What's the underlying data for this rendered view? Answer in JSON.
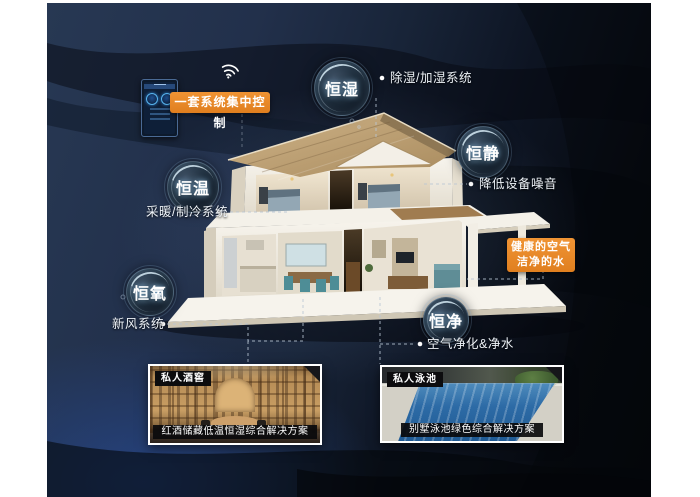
{
  "colors": {
    "canvas_navy": "#1c2b47",
    "accent_orange": "#e8872b",
    "bubble_text": "#ffffff",
    "caption_bg": "#0c0c0e"
  },
  "control_panel": {
    "label": "一套系统集中控制",
    "wifi_icon": "wifi-icon"
  },
  "bubbles": [
    {
      "id": "constant-humidity",
      "label": "恒湿"
    },
    {
      "id": "constant-quiet",
      "label": "恒静"
    },
    {
      "id": "constant-temperature",
      "label": "恒温"
    },
    {
      "id": "constant-oxygen",
      "label": "恒氧"
    },
    {
      "id": "constant-purity",
      "label": "恒净"
    }
  ],
  "annotations": [
    {
      "id": "dehumidify-humidify-system",
      "label": "除湿/加湿系统"
    },
    {
      "id": "reduce-equipment-noise",
      "label": "降低设备噪音"
    },
    {
      "id": "heating-cooling-system",
      "label": "采暖/制冷系统"
    },
    {
      "id": "fresh-air-system",
      "label": "新风系统"
    },
    {
      "id": "air-purification-water-purification",
      "label": "空气净化&净水"
    }
  ],
  "highlight_box": {
    "line1": "健康的空气",
    "line2": "洁净的水"
  },
  "cards": [
    {
      "id": "wine-cellar",
      "tag": "私人酒窖",
      "caption": "红酒储藏低温恒湿综合解决方案"
    },
    {
      "id": "pool",
      "tag": "私人泳池",
      "caption": "别墅泳池绿色综合解决方案"
    }
  ]
}
